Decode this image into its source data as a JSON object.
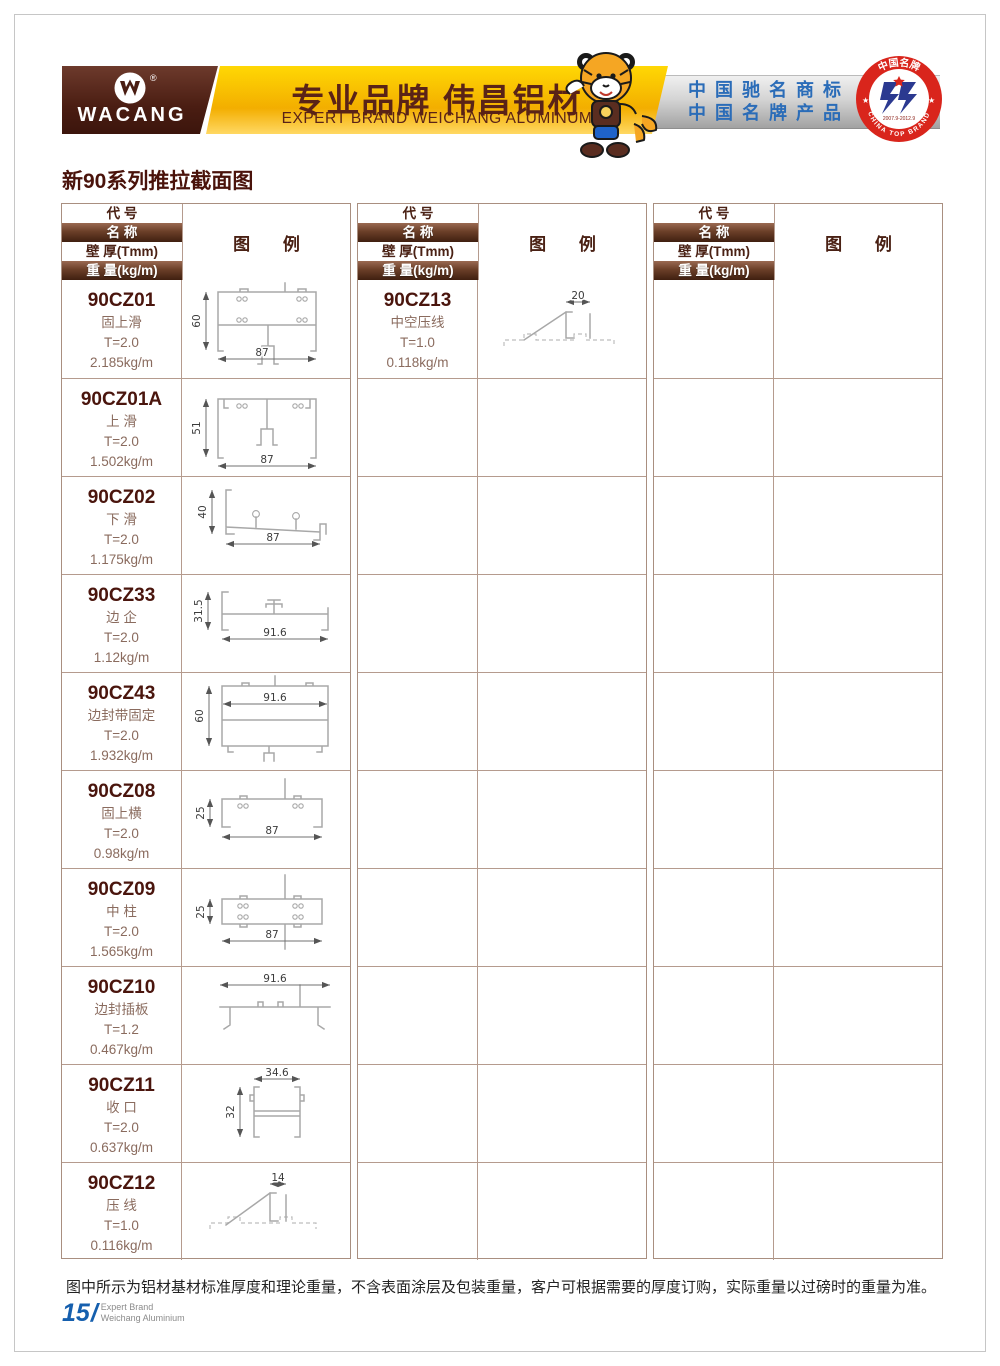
{
  "header": {
    "logo": {
      "brand": "WACANG",
      "registered": "®"
    },
    "banner": {
      "title_cn": "专业品牌  伟昌铝材",
      "title_en": "EXPERT BRAND WEICHANG ALUMINUM"
    },
    "honors": {
      "line1": "中国驰名商标",
      "line2": "中国名牌产品"
    },
    "badge": {
      "top": "中国名牌",
      "bottom": "CHINA TOP BRAND",
      "years": "2007.9-2012.9"
    }
  },
  "page": {
    "title": "新90系列推拉截面图",
    "note": "图中所示为铝材基材标准厚度和理论重量，不含表面涂层及包装重量，客户可根据需要的厚度订购，实际重量以过磅时的重量为准。",
    "page_number": "15",
    "page_number_slash": "/",
    "brand_line1": "Expert Brand",
    "brand_line2": "Weichang Aluminium"
  },
  "colors": {
    "brown_dark": "#4a1d12",
    "banner_yellow": "#f3ae00",
    "banner_text": "#5a2317",
    "honor_blue": "#2a6cb8",
    "badge_red": "#d9251c",
    "badge_blue": "#2b3990",
    "grid_line": "#b59b8e",
    "page_number_blue": "#155fae"
  },
  "table": {
    "headers": {
      "code": "代 号",
      "name": "名 称",
      "thickness": "壁 厚(Tmm)",
      "weight": "重 量(kg/m)",
      "diagram": "图 例"
    },
    "groups": [
      {
        "rows": [
          {
            "code": "90CZ01",
            "name": "固上滑",
            "thickness": "T=2.0",
            "weight": "2.185kg/m",
            "dims": [
              "60",
              "87"
            ]
          },
          {
            "code": "90CZ01A",
            "name": "上 滑",
            "thickness": "T=2.0",
            "weight": "1.502kg/m",
            "dims": [
              "51",
              "87"
            ]
          },
          {
            "code": "90CZ02",
            "name": "下 滑",
            "thickness": "T=2.0",
            "weight": "1.175kg/m",
            "dims": [
              "40",
              "87"
            ]
          },
          {
            "code": "90CZ33",
            "name": "边 企",
            "thickness": "T=2.0",
            "weight": "1.12kg/m",
            "dims": [
              "31.5",
              "91.6"
            ]
          },
          {
            "code": "90CZ43",
            "name": "边封带固定",
            "thickness": "T=2.0",
            "weight": "1.932kg/m",
            "dims": [
              "60",
              "91.6"
            ]
          },
          {
            "code": "90CZ08",
            "name": "固上横",
            "thickness": "T=2.0",
            "weight": "0.98kg/m",
            "dims": [
              "25",
              "87"
            ]
          },
          {
            "code": "90CZ09",
            "name": "中 柱",
            "thickness": "T=2.0",
            "weight": "1.565kg/m",
            "dims": [
              "25",
              "87"
            ]
          },
          {
            "code": "90CZ10",
            "name": "边封插板",
            "thickness": "T=1.2",
            "weight": "0.467kg/m",
            "dims": [
              "91.6"
            ]
          },
          {
            "code": "90CZ11",
            "name": "收 口",
            "thickness": "T=2.0",
            "weight": "0.637kg/m",
            "dims": [
              "34.6",
              "32"
            ]
          },
          {
            "code": "90CZ12",
            "name": "压 线",
            "thickness": "T=1.0",
            "weight": "0.116kg/m",
            "dims": [
              "14"
            ]
          }
        ]
      },
      {
        "rows": [
          {
            "code": "90CZ13",
            "name": "中空压线",
            "thickness": "T=1.0",
            "weight": "0.118kg/m",
            "dims": [
              "20"
            ]
          }
        ]
      },
      {
        "rows": []
      }
    ]
  }
}
